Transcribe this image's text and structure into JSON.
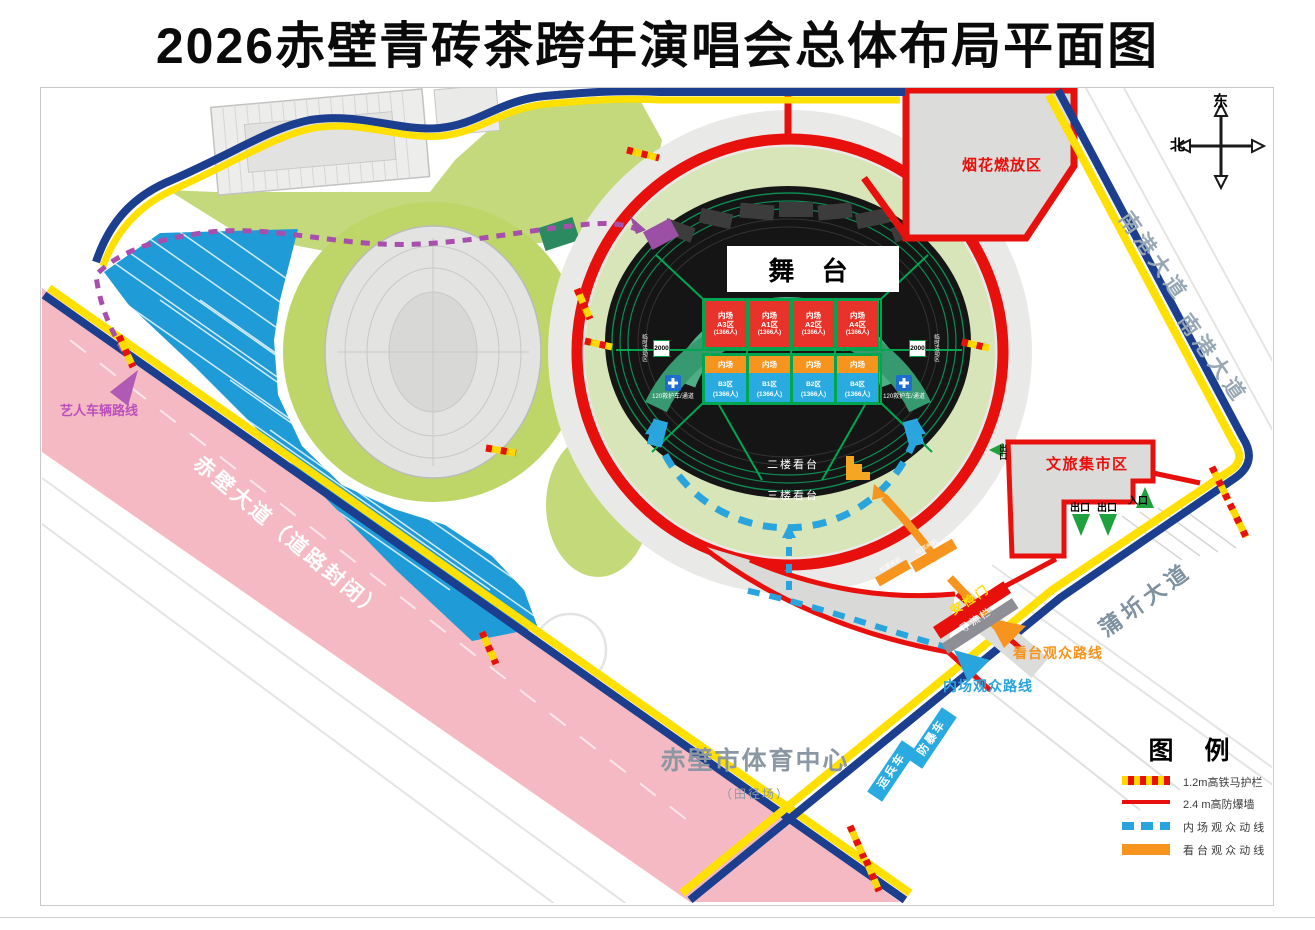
{
  "title": "2026赤壁青砖茶跨年演唱会总体布局平面图",
  "compass": {
    "east": "东",
    "north": "北"
  },
  "zones": {
    "fireworks": "烟花燃放区",
    "market": "文旅集市区",
    "stage": "舞 台",
    "stand_l2": "二楼看台",
    "stand_l3": "三楼看台",
    "sports_center": "赤壁市体育中心",
    "track_field": "（田径场）",
    "temp_zone_left": "临时活动区",
    "temp_zone_right": "临时活动区",
    "temp_count_left": "2000",
    "temp_count_right": "2000",
    "ambulance_left": "120救护车/通道",
    "ambulance_right": "120救护车/通道"
  },
  "roads": {
    "chibi_avenue": "赤壁大道（道路封闭）",
    "nangang_avenue": "南港大道",
    "puqi_avenue": "蒲圻大道"
  },
  "routes": {
    "artist": "艺人车辆路线",
    "infield_audience": "内场观众路线",
    "stand_audience": "看台观众路线"
  },
  "gates": {
    "security": "安检门",
    "diversion": "导流栏",
    "ticket_left": "检票闸机",
    "ticket_right": "检票闸机",
    "market_exit_a": "出口",
    "market_exit_b": "出口",
    "market_entry": "入口",
    "market_exit_side": "出口"
  },
  "vehicles": {
    "troop_carrier": "运兵车",
    "riot_vehicle": "防暴车"
  },
  "seating": {
    "row_a": [
      {
        "zone": "内场",
        "name": "A3区",
        "capacity": "(1366人)"
      },
      {
        "zone": "内场",
        "name": "A1区",
        "capacity": "(1366人)"
      },
      {
        "zone": "内场",
        "name": "A2区",
        "capacity": "(1366人)"
      },
      {
        "zone": "内场",
        "name": "A4区",
        "capacity": "(1366人)"
      }
    ],
    "row_b": [
      {
        "zone": "内场",
        "name": "B3区",
        "capacity": "(1366人)"
      },
      {
        "zone": "内场",
        "name": "B1区",
        "capacity": "(1366人)"
      },
      {
        "zone": "内场",
        "name": "B2区",
        "capacity": "(1366人)"
      },
      {
        "zone": "内场",
        "name": "B4区",
        "capacity": "(1366人)"
      }
    ]
  },
  "legend": {
    "title": "图 例",
    "items": [
      {
        "type": "barrier",
        "label": "1.2m高铁马护栏"
      },
      {
        "type": "wall",
        "label": "2.4 m高防爆墙"
      },
      {
        "type": "infield-flow",
        "label": "内 场 观 众 动 线"
      },
      {
        "type": "stand-flow",
        "label": "看 台 观 众 动 线"
      }
    ]
  },
  "colors": {
    "wall_red": "#e8100c",
    "barrier_yellow": "#ffd800",
    "infield_blue": "#2aa4dd",
    "stand_orange": "#f7941d",
    "boundary_navy": "#1b3e8f",
    "boundary_yellow": "#ffe000",
    "parking_blue": "#1f9cd8",
    "road_pink": "#f4b9c3",
    "artist_purple": "#a84fae"
  }
}
